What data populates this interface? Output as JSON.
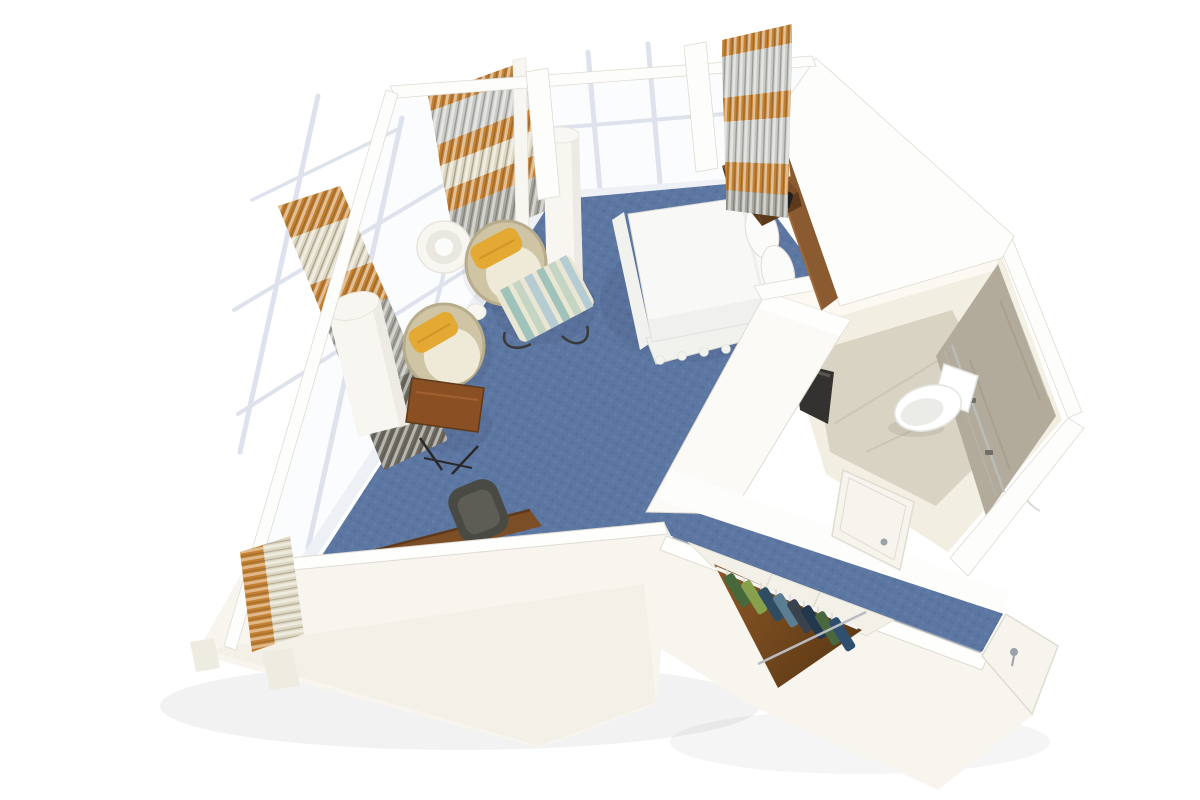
{
  "meta": {
    "description": "Isometric 3D cutaway rendering of a stateroom floor plan",
    "view": "overhead three-quarter cutaway"
  },
  "scene": {
    "rooms": [
      {
        "label": "bedroom",
        "floor": "blue carpet"
      },
      {
        "label": "bathroom",
        "floor": "stone tile"
      },
      {
        "label": "wardrobe closet",
        "floor": "wood"
      },
      {
        "label": "entry corridor",
        "floor": "blue carpet"
      }
    ],
    "objects": [
      "double bed with white linens",
      "two white pillows",
      "wood headboard panel",
      "wood nightstand",
      "white table lamp",
      "black telephone",
      "striped vertical drape panels",
      "floor-to-ceiling windows",
      "white columns",
      "barrel chair with yellow accent pillow",
      "second barrel chair with yellow pillow",
      "striped ottoman on wire base",
      "white drum floor lamp",
      "wood side table with metal legs",
      "wood desk",
      "dark desk chair",
      "toilet",
      "dark vanity counter",
      "stone shower wall with glass door",
      "shower head",
      "bathroom door",
      "closet rail with hanging clothes",
      "entry door with metal handle"
    ]
  },
  "colors": {
    "bg": "#ffffff",
    "glass": "#fbfcfe",
    "mullion": "#dde2ec",
    "sill": "#edf0f5",
    "wall_top": "#fdfdfb",
    "wall_rim": "#fefefc",
    "wall_face": "#f7f5ee",
    "wall_shade": "#eeebe0",
    "wall_edge": "#dedcd1",
    "carpet": "#5d77a3",
    "carpet_dark": "#4f6892",
    "carpet_light": "#7187ac",
    "carpet_edge": "#43587d",
    "wedge_face": "#fbfaf6",
    "bath_wall": "#f2eee2",
    "bath_wall_bright": "#fbf9f1",
    "bath_floor": "#d9d3c3",
    "bath_floor_streak": "#c8c1ae",
    "marble": "#b2ab9b",
    "marble_streak": "#a19987",
    "glass_line": "#b9beba",
    "hinge": "#6f6f6a",
    "toilet": "#ffffff",
    "toilet_shade": "#e3e3df",
    "vanity": "#343230",
    "vanity_hi": "#5a5751",
    "door": "#f6f4ed",
    "door_edge": "#dfdcd1",
    "handle": "#99a1a9",
    "closet_wall": "#f3f0e8",
    "closet_floor_a": "#8d5827",
    "closet_floor_b": "#5d3a15",
    "rail": "#f4f4f2",
    "bar": "#b9bcc0",
    "hanger": "#d9d9d7",
    "clothes": [
      "#47683a",
      "#86a04c",
      "#2e4d62",
      "#5c7e94",
      "#39424d",
      "#22384f",
      "#49683f",
      "#2e4f6e"
    ],
    "bed_linen": "#f8f8f7",
    "bed_shade": "#ebebe7",
    "bed_skirt": "#f1f1ee",
    "bed_edge": "#dcdcd8",
    "pillow_white": "#fbfbfa",
    "headboard": "#8a5a30",
    "headboard_hi": "#a06a38",
    "nightstand": "#7b4e27",
    "nightstand_dark": "#5c3a1a",
    "phone": "#1f1f1f",
    "phone_key": "#6f6f6f",
    "lamp_body": "#f8f7f3",
    "lamp_edge": "#e7e5dc",
    "lamp_ring_mid": "#e9e7df",
    "lamp_ring_in": "#fbfbf9",
    "chair_shell": "#cfc5a5",
    "chair_shell_dark": "#b7ac8b",
    "chair_seat": "#efe9d7",
    "pillow_yellow": "#e3a933",
    "pillow_yellow_dark": "#bf8a22",
    "ott_base": "#e9e6d3",
    "ott_teal": "#9fc3ba",
    "ott_sage": "#c5d5c3",
    "ott_blue": "#b4ccd2",
    "wire": "#3a3a3a",
    "table_wood": "#8a4f22",
    "table_wood_hi": "#a96a33",
    "leg": "#2a2a2a",
    "desk_wood": "#7c4e26",
    "desk_wood_dark": "#5e3a1a",
    "desk_chair": "#4a4a44",
    "desk_chair_hi": "#5d5d56",
    "curtain_orange": "#c4802f",
    "curtain_orange_dk": "#9a5f1c",
    "curtain_cream": "#ded8c2",
    "curtain_silver": "#c9cbc7",
    "curtain_gray": "#a7a7a0",
    "curtain_slate": "#6d6a60",
    "slat_hi": "#ffffff",
    "slat_dk": "#4a4238",
    "cyl_body": "#f7f6f1",
    "cyl_shade": "#e9e7de",
    "cord": "#d8d8d3",
    "shower_head": "#f1f0ec",
    "shadow": "#000000"
  }
}
